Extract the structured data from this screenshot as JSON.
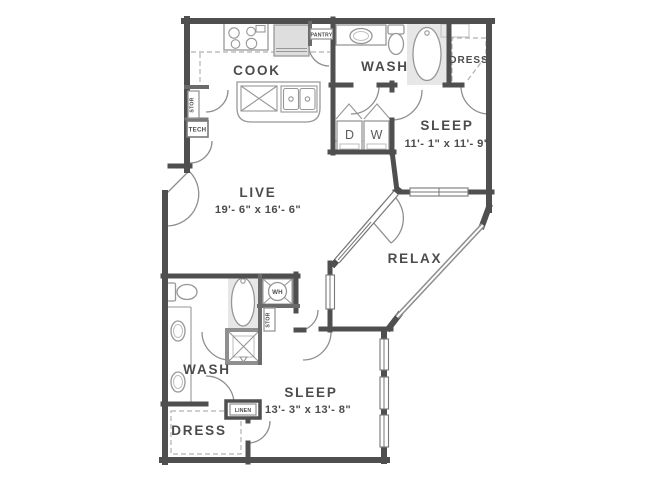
{
  "floor_plan": {
    "rooms": {
      "cook": {
        "label": "COOK"
      },
      "live": {
        "label": "LIVE",
        "dims": "19'- 6\" x 16'- 6\""
      },
      "relax": {
        "label": "RELAX"
      },
      "wash_upper": {
        "label": "WASH"
      },
      "dress_upper": {
        "label": "DRESS"
      },
      "sleep_upper": {
        "label": "SLEEP",
        "dims": "11'- 1\" x 11'- 9\""
      },
      "wash_lower": {
        "label": "WASH"
      },
      "dress_lower": {
        "label": "DRESS"
      },
      "sleep_lower": {
        "label": "SLEEP",
        "dims": "13'- 3\" x 13'- 8\""
      }
    },
    "closets": {
      "pantry": "PANTRY",
      "stor_upper": "STOR",
      "tech": "TECH",
      "stor_lower": "STOR",
      "linen": "LINEN"
    },
    "appliances": {
      "dryer": "D",
      "washer": "W",
      "water_heater": "WH"
    },
    "colors": {
      "wall": "#4f4f4f",
      "fixture": "#979797",
      "shade": "#e7e7e7",
      "text": "#4c4c4c",
      "background": "#ffffff"
    }
  }
}
